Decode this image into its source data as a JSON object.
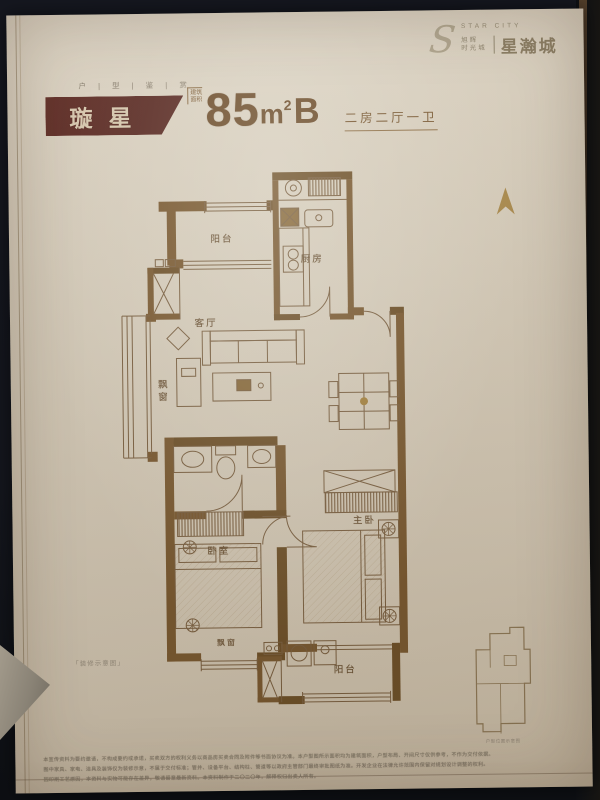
{
  "header": {
    "s": "S",
    "star_city": "STAR CITY",
    "brand1": "旭辉",
    "brand2": "时光城",
    "name": "星瀚城"
  },
  "title": {
    "eyebrow": "户 | 型 | 鉴 | 赏",
    "name": "璇星",
    "area_label1": "建筑",
    "area_label2": "面积",
    "area_value": "85",
    "area_unit": "m",
    "area_sup": "2",
    "area_type": "B",
    "spec": "二房二厅一卫"
  },
  "plan": {
    "balcony_top": "阳台",
    "kitchen": "厨房",
    "living": "客厅",
    "bay_left": "飘窗",
    "bedroom": "卧室",
    "master": "主卧",
    "bay_bottom": "飘窗",
    "balcony_bottom": "阳台",
    "note": "「装修示意图」",
    "keyplan_caption": "户型位置示意图"
  },
  "footer": {
    "line1": "本宣传资料为要约邀请，不构成要约或承诺，买卖双方的权利义务以商品房买卖合同及附件等书面协议为准。本户型图所示面积均为建筑面积，户型布局、开间尺寸仅供参考，不作为交付依据。",
    "line2": "图中家具、家电、洁具及装饰仅为装修示意，不属于交付标准；管井、设备平台、结构柱、管道等以政府主管部门最终审批图纸为准。开发企业在法律允许范围内保留对规划设计调整的权利。",
    "line3": "因印刷工艺原因，本资料与实物可能存在差异，敬请留意最新资料。本资料制作于二〇二〇年，解释权归出卖人所有。"
  },
  "colors": {
    "maroon": "#5d2b24",
    "line_brown": "#7c6142",
    "wall_brown": "#7b5a31",
    "gold": "#a8843f",
    "text_brown": "#6b4a28",
    "paper": "#dcd3c2"
  }
}
